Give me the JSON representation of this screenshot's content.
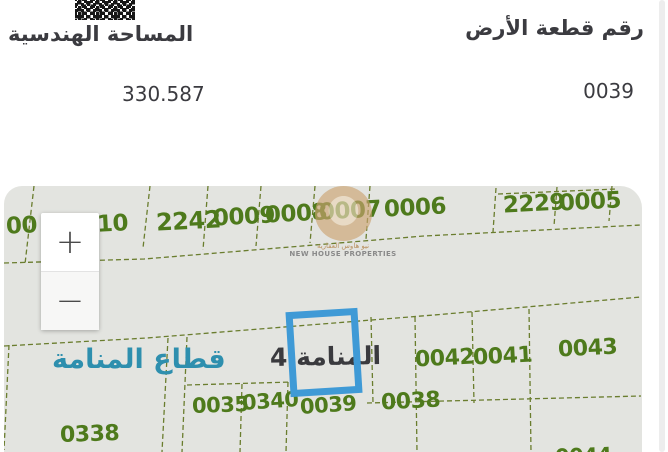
{
  "header": {
    "left": {
      "label": "المساحة الهندسية",
      "value": "330.587"
    },
    "right": {
      "label": "رقم قطعة الأرض",
      "value": "0039"
    }
  },
  "map": {
    "sector_label": "قطاع المنامة",
    "area_label": "المنامة 4",
    "watermark": {
      "arabic": "نيو هاوس العقارية",
      "english": "NEW HOUSE PROPERTIES"
    },
    "zoom_in_label": "+",
    "zoom_out_label": "−",
    "colors": {
      "background": "#e3e4e0",
      "parcel_text": "#4e7a1c",
      "boundary_line": "#6a7d2e",
      "highlight_box": "#3f9ad6",
      "sector_text": "#2e8fae"
    },
    "highlighted_parcel": "0039",
    "parcels": [
      {
        "label": "00",
        "x": 2,
        "y": 27,
        "fs": 23,
        "rot": -3
      },
      {
        "label": "10",
        "x": 93,
        "y": 25,
        "fs": 23,
        "rot": -3
      },
      {
        "label": "2242",
        "x": 152,
        "y": 21,
        "fs": 24,
        "rot": -3
      },
      {
        "label": "0009",
        "x": 209,
        "y": 18,
        "fs": 23,
        "rot": -3
      },
      {
        "label": "0008",
        "x": 261,
        "y": 15,
        "fs": 23,
        "rot": -3
      },
      {
        "label": "0007",
        "x": 315,
        "y": 12,
        "fs": 23,
        "rot": -3
      },
      {
        "label": "0006",
        "x": 380,
        "y": 9,
        "fs": 23,
        "rot": -3
      },
      {
        "label": "2229",
        "x": 499,
        "y": 5,
        "fs": 23,
        "rot": -3
      },
      {
        "label": "0005",
        "x": 555,
        "y": 3,
        "fs": 23,
        "rot": -3
      },
      {
        "label": "0042",
        "x": 411,
        "y": 160,
        "fs": 22,
        "rot": -3
      },
      {
        "label": "0041",
        "x": 469,
        "y": 158,
        "fs": 22,
        "rot": -3
      },
      {
        "label": "0043",
        "x": 554,
        "y": 150,
        "fs": 22,
        "rot": -3
      },
      {
        "label": "0038",
        "x": 377,
        "y": 203,
        "fs": 22,
        "rot": -3
      },
      {
        "label": "0035",
        "x": 188,
        "y": 207,
        "fs": 21,
        "rot": -2
      },
      {
        "label": "0340",
        "x": 238,
        "y": 203,
        "fs": 21,
        "rot": -4
      },
      {
        "label": "0039",
        "x": 296,
        "y": 207,
        "fs": 21,
        "rot": -4
      },
      {
        "label": "0338",
        "x": 56,
        "y": 236,
        "fs": 22,
        "rot": -2
      },
      {
        "label": "0044",
        "x": 551,
        "y": 258,
        "fs": 21,
        "rot": -2
      }
    ],
    "boundaries": [
      "M30,0 L21,78",
      "M146,0 L139,62",
      "M204,0 L199,64",
      "M257,0 L252,60",
      "M311,0 L306,57",
      "M366,0 L362,53",
      "M492,2 L489,46",
      "M553,1 L550,40",
      "M608,0 L605,35",
      "M494,8 L612,3",
      "M0,77 L140,73 L420,50 L637,39",
      "M0,160 L143,152 L430,129 L637,111",
      "M5,159 L0,264",
      "M164,152 L158,266",
      "M183,151 L178,266",
      "M183,199 L288,196",
      "M238,198 L236,266",
      "M284,196 L282,266",
      "M367,131 L369,217",
      "M411,131 L413,266",
      "M468,126 L470,217",
      "M525,123 L527,266",
      "M363,217 L637,210"
    ]
  }
}
